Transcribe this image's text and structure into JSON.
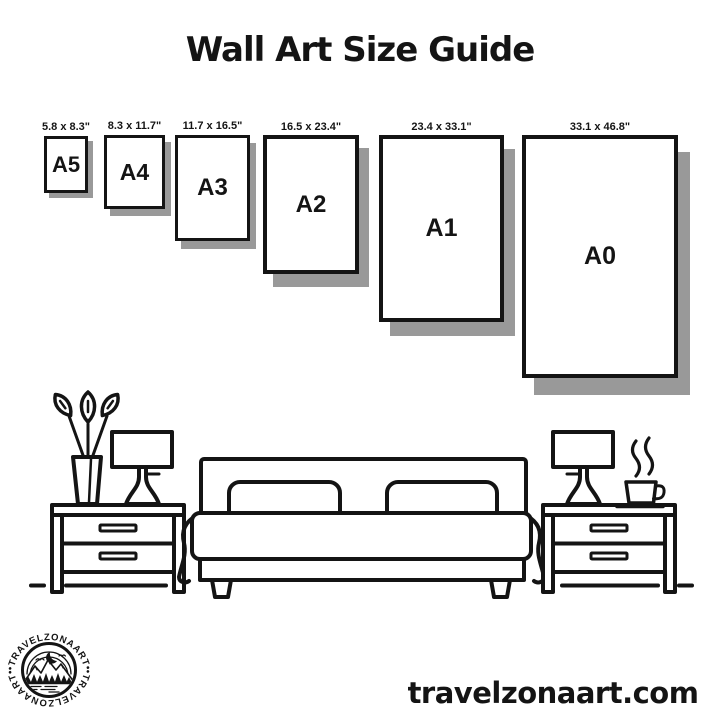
{
  "title": "Wall Art Size Guide",
  "sizes": [
    {
      "name": "A5",
      "dimensions": "5.8 x 8.3\""
    },
    {
      "name": "A4",
      "dimensions": "8.3 x 11.7\""
    },
    {
      "name": "A3",
      "dimensions": "11.7 x 16.5\""
    },
    {
      "name": "A2",
      "dimensions": "16.5 x 23.4\""
    },
    {
      "name": "A1",
      "dimensions": "23.4 x 33.1\""
    },
    {
      "name": "A0",
      "dimensions": "33.1 x 46.8\""
    }
  ],
  "footer": {
    "website": "travelzonaart.com",
    "brand": "• TRAVELZONAART •"
  },
  "colors": {
    "ink": "#141414",
    "background": "#ffffff",
    "frame_shadow": "#999999"
  },
  "scene_icons": [
    "plant-vase-icon",
    "table-lamp-icon",
    "nightstand-icon",
    "bed-icon",
    "coffee-cup-icon",
    "steam-icon",
    "floor-line"
  ]
}
